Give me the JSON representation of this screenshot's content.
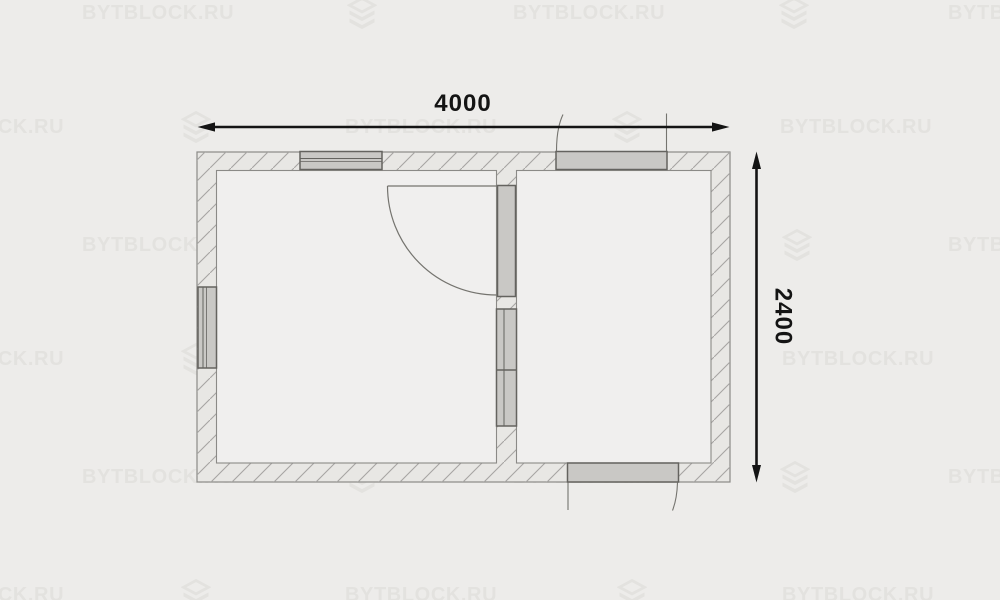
{
  "plan": {
    "title": "floor-plan",
    "dimensions": {
      "width_label": "4000",
      "height_label": "2400"
    },
    "elements": {
      "exterior_walls": "hatched perimeter wall",
      "interior_wall": "hatched partition wall with two windows",
      "windows": [
        "top-wall-window",
        "left-wall-window",
        "partition-window-upper",
        "partition-window-lower"
      ],
      "doors": [
        "interior-door-with-swing-arc",
        "top-exterior-door",
        "bottom-exterior-door"
      ]
    }
  },
  "watermark": {
    "text": "BYTBLOCK.RU",
    "icon_name": "block-logo-icon",
    "color": "#e3e2df",
    "rows": [
      {
        "y": 2,
        "texts": [
          82,
          513,
          948
        ],
        "icons": [
          347,
          779
        ]
      },
      {
        "y": 116,
        "texts": [
          -88,
          345,
          780
        ],
        "icons": [
          181,
          612
        ]
      },
      {
        "y": 234,
        "texts": [
          82,
          517,
          948
        ],
        "icons": [
          347,
          782
        ]
      },
      {
        "y": 348,
        "texts": [
          -88,
          345,
          782
        ],
        "icons": [
          181,
          617
        ]
      },
      {
        "y": 466,
        "texts": [
          82,
          513,
          948
        ],
        "icons": [
          347,
          780
        ]
      },
      {
        "y": 584,
        "texts": [
          -88,
          345,
          782
        ],
        "icons": [
          181,
          617
        ]
      }
    ]
  },
  "colors": {
    "background": "#edecea",
    "watermark": "#e3e2df",
    "wall_fill": "#e8e7e4",
    "hatch_line": "#a6a5a2",
    "wall_stroke": "#8b8a87",
    "room_fill": "#f0efee",
    "fixture_fill": "#c9c8c5",
    "fixture_stroke": "#64635f",
    "swing_line": "#75746f",
    "dimension": "#141414"
  }
}
